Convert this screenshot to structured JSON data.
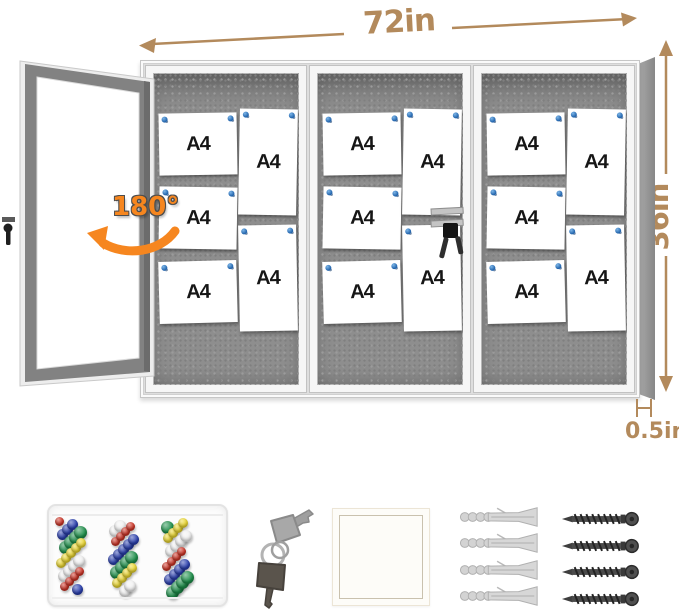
{
  "product_diagram": {
    "width_label": "72in",
    "height_label": "36in",
    "depth_label": "0.5in",
    "door_swing_label": "180°"
  },
  "board": {
    "panel_count": 3,
    "panels": [
      {
        "papers": [
          {
            "label": "A4",
            "orient": "landscape"
          },
          {
            "label": "A4",
            "orient": "landscape"
          },
          {
            "label": "A4",
            "orient": "landscape"
          },
          {
            "label": "A4",
            "orient": "portrait"
          },
          {
            "label": "A4",
            "orient": "portrait"
          }
        ]
      },
      {
        "papers": [
          {
            "label": "A4",
            "orient": "landscape"
          },
          {
            "label": "A4",
            "orient": "landscape"
          },
          {
            "label": "A4",
            "orient": "landscape"
          },
          {
            "label": "A4",
            "orient": "portrait"
          },
          {
            "label": "A4",
            "orient": "portrait"
          }
        ]
      },
      {
        "papers": [
          {
            "label": "A4",
            "orient": "landscape"
          },
          {
            "label": "A4",
            "orient": "landscape"
          },
          {
            "label": "A4",
            "orient": "landscape"
          },
          {
            "label": "A4",
            "orient": "portrait"
          },
          {
            "label": "A4",
            "orient": "portrait"
          }
        ]
      }
    ],
    "colors": {
      "felt": "#8e8e8e",
      "frame": "#f6f6f6",
      "pin": "#1d5fa8"
    }
  },
  "annotations": {
    "dimension_color": "#b38a5c",
    "swing_color": "#f6861f"
  },
  "accessories": {
    "push_pin_box": {
      "pin_count": 64,
      "pin_colors": [
        "#d03527",
        "#2a3fae",
        "#1e8e4a",
        "#ecd832",
        "#f2f2f2"
      ]
    },
    "keys": {
      "count": 2
    },
    "wall_anchors": {
      "count": 4
    },
    "screws": {
      "count": 4
    }
  }
}
